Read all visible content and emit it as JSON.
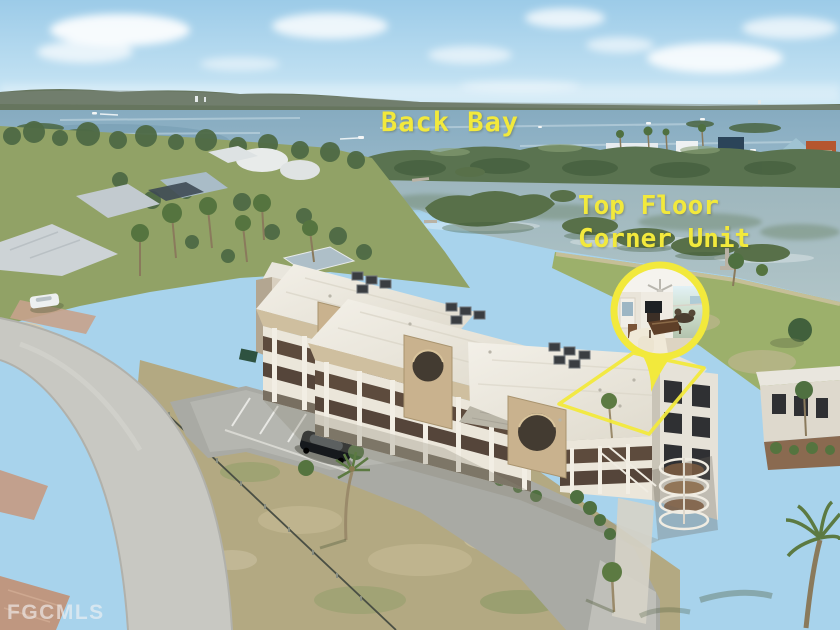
{
  "meta": {
    "width": 840,
    "height": 630,
    "kind": "aerial real-estate listing photo"
  },
  "annotations": {
    "back_bay_label": "Back Bay",
    "unit_label_line1": "Top Floor",
    "unit_label_line2": "Corner Unit",
    "watermark": "FGCMLS"
  },
  "colors": {
    "highlight_yellow": "#F2E93C",
    "sky": "#A8D3EC",
    "bay_water": "#8AAEC2",
    "lagoon_water": "#A7BDC2",
    "mangrove_green": "#5C7450",
    "lawn_green": "#9AAC6A",
    "dry_grass": "#B5AB85",
    "road_concrete": "#C6C6C0",
    "parking_asphalt": "#A9AAA4",
    "roof_white": "#EDEAE1",
    "wall_tan": "#C9B28E",
    "balcony_brown": "#5B4A3C",
    "watermark_white": "rgba(242,242,242,0.62)"
  },
  "scene": {
    "description": "Drone view of a three-story tan condo building with white roof, round wall cutouts and a spiral stair; Back Bay, mangrove islands and a lagoon behind; residential street, parking lot with dark SUV, palms and dry lawn in front.",
    "callout": "Yellow circle inset shows the top-floor corner unit living room opening to a lanai with water view; arrow and yellow outline mark the unit roof."
  }
}
